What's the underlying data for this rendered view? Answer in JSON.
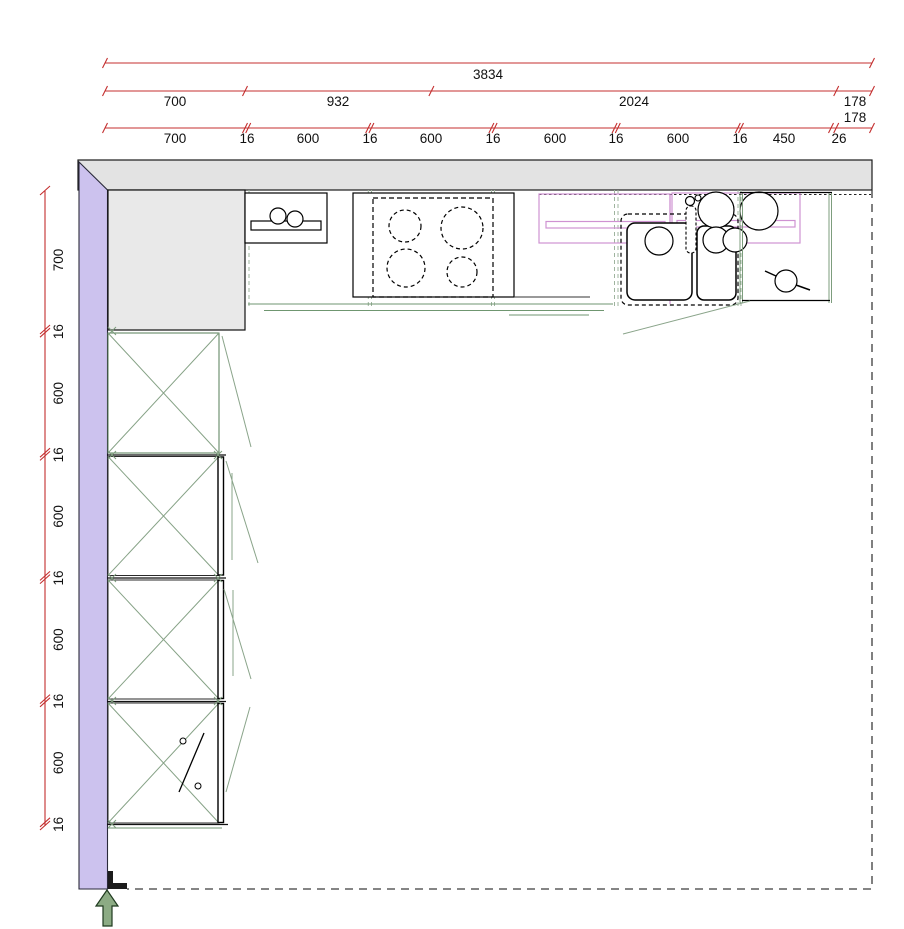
{
  "dimensions": {
    "top_overall": "3834",
    "top_sections": [
      "700",
      "932",
      "2024",
      "178"
    ],
    "top_overflow": "178",
    "top_detail": [
      "700",
      "16",
      "600",
      "16",
      "600",
      "16",
      "600",
      "16",
      "600",
      "16",
      "450",
      "26"
    ],
    "left_detail": [
      "700",
      "16",
      "600",
      "16",
      "600",
      "16",
      "600",
      "16",
      "600",
      "16"
    ]
  },
  "colors": {
    "dimension_red": "#c42f2f",
    "top_wall_fill": "#e3e3e3",
    "left_wall_fill": "#ccc2ee",
    "cabinet_green": "#7d9d7d",
    "gap_dash_green": "#9fb49f",
    "wall_cabinet_pink": "#cf92d2",
    "arrow_green": "#8cab84"
  }
}
